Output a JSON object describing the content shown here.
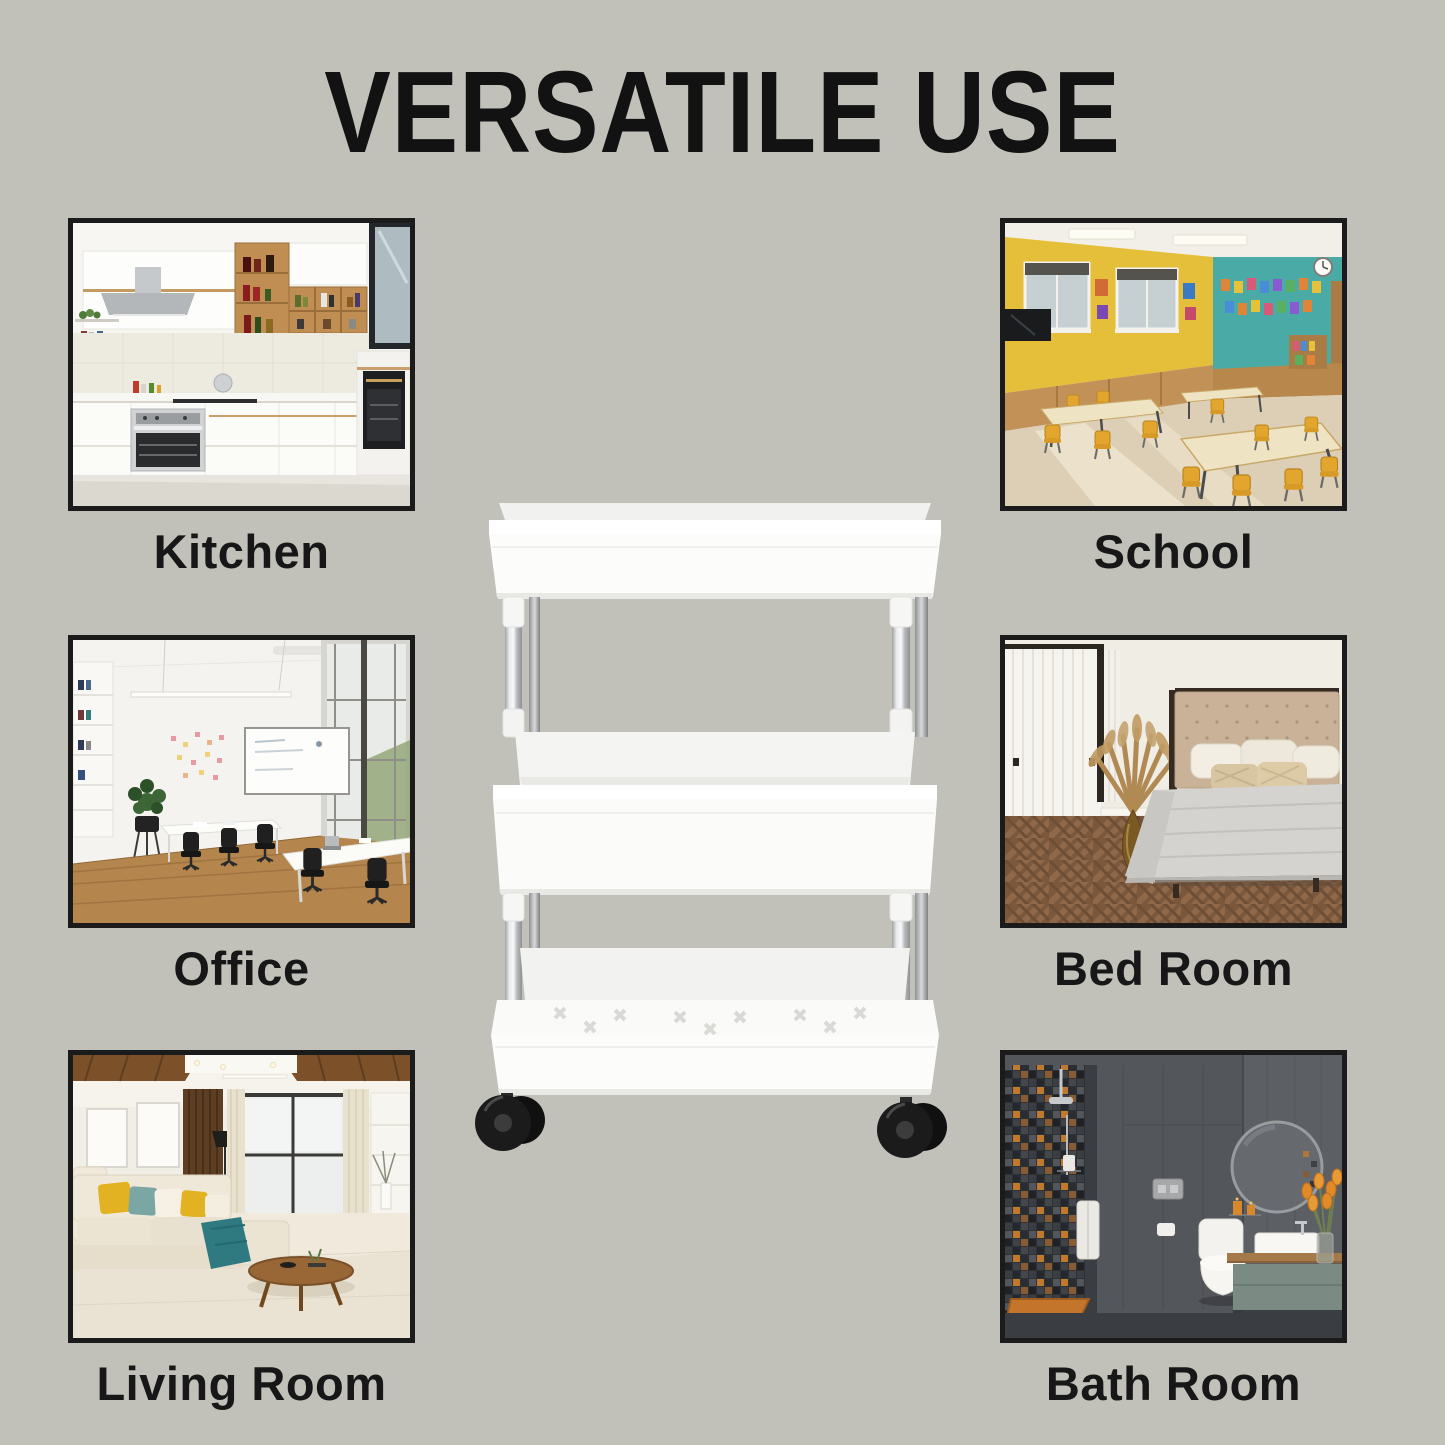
{
  "title": "VERSATILE USE",
  "rooms": [
    {
      "label": "Kitchen",
      "photo_alt": "Bright white modern kitchen with wall cabinets, wooden open shelves with bottles, range hood, built-in silver oven and tall black oven column"
    },
    {
      "label": "Office",
      "photo_alt": "White open-plan office with wooden floor, black swivel chairs, white desks, whiteboard, sticky notes, potted plant and tall windows"
    },
    {
      "label": "Living Room",
      "photo_alt": "Modern living room with cream sectional sofa, yellow and teal pillows, teal throw, round wooden coffee table, wood ceiling accents and large window"
    },
    {
      "label": "School",
      "photo_alt": "Classroom with yellow chairs and cream tables, yellow window wall with posters, teal display wall with artwork, wall clock and glossy sunlit floor"
    },
    {
      "label": "Bed Room",
      "photo_alt": "Bedroom with beige tufted headboard, grey bedding draped over the bed, sheer curtains, amber vase with dried pampas and herringbone parquet floor"
    },
    {
      "label": "Bath Room",
      "photo_alt": "Dark grey bathroom with mosaic shower wall, hanging towel, orange shower tray, wall-hung toilet, round mirror, floating vanity with white basin and orange tulips"
    }
  ],
  "product": {
    "name": "3-Tier Slim Rolling Storage Cart",
    "tier_count": "3",
    "color": "White"
  },
  "colors": {
    "background": "#c1c1b9",
    "title_text": "#121212",
    "label_text": "#171717",
    "photo_border": "#1b1b1b",
    "cart_plastic": "#fbfbfa",
    "cart_pole_chrome": "#c9cbcd",
    "caster_black": "#1b1b1b"
  }
}
